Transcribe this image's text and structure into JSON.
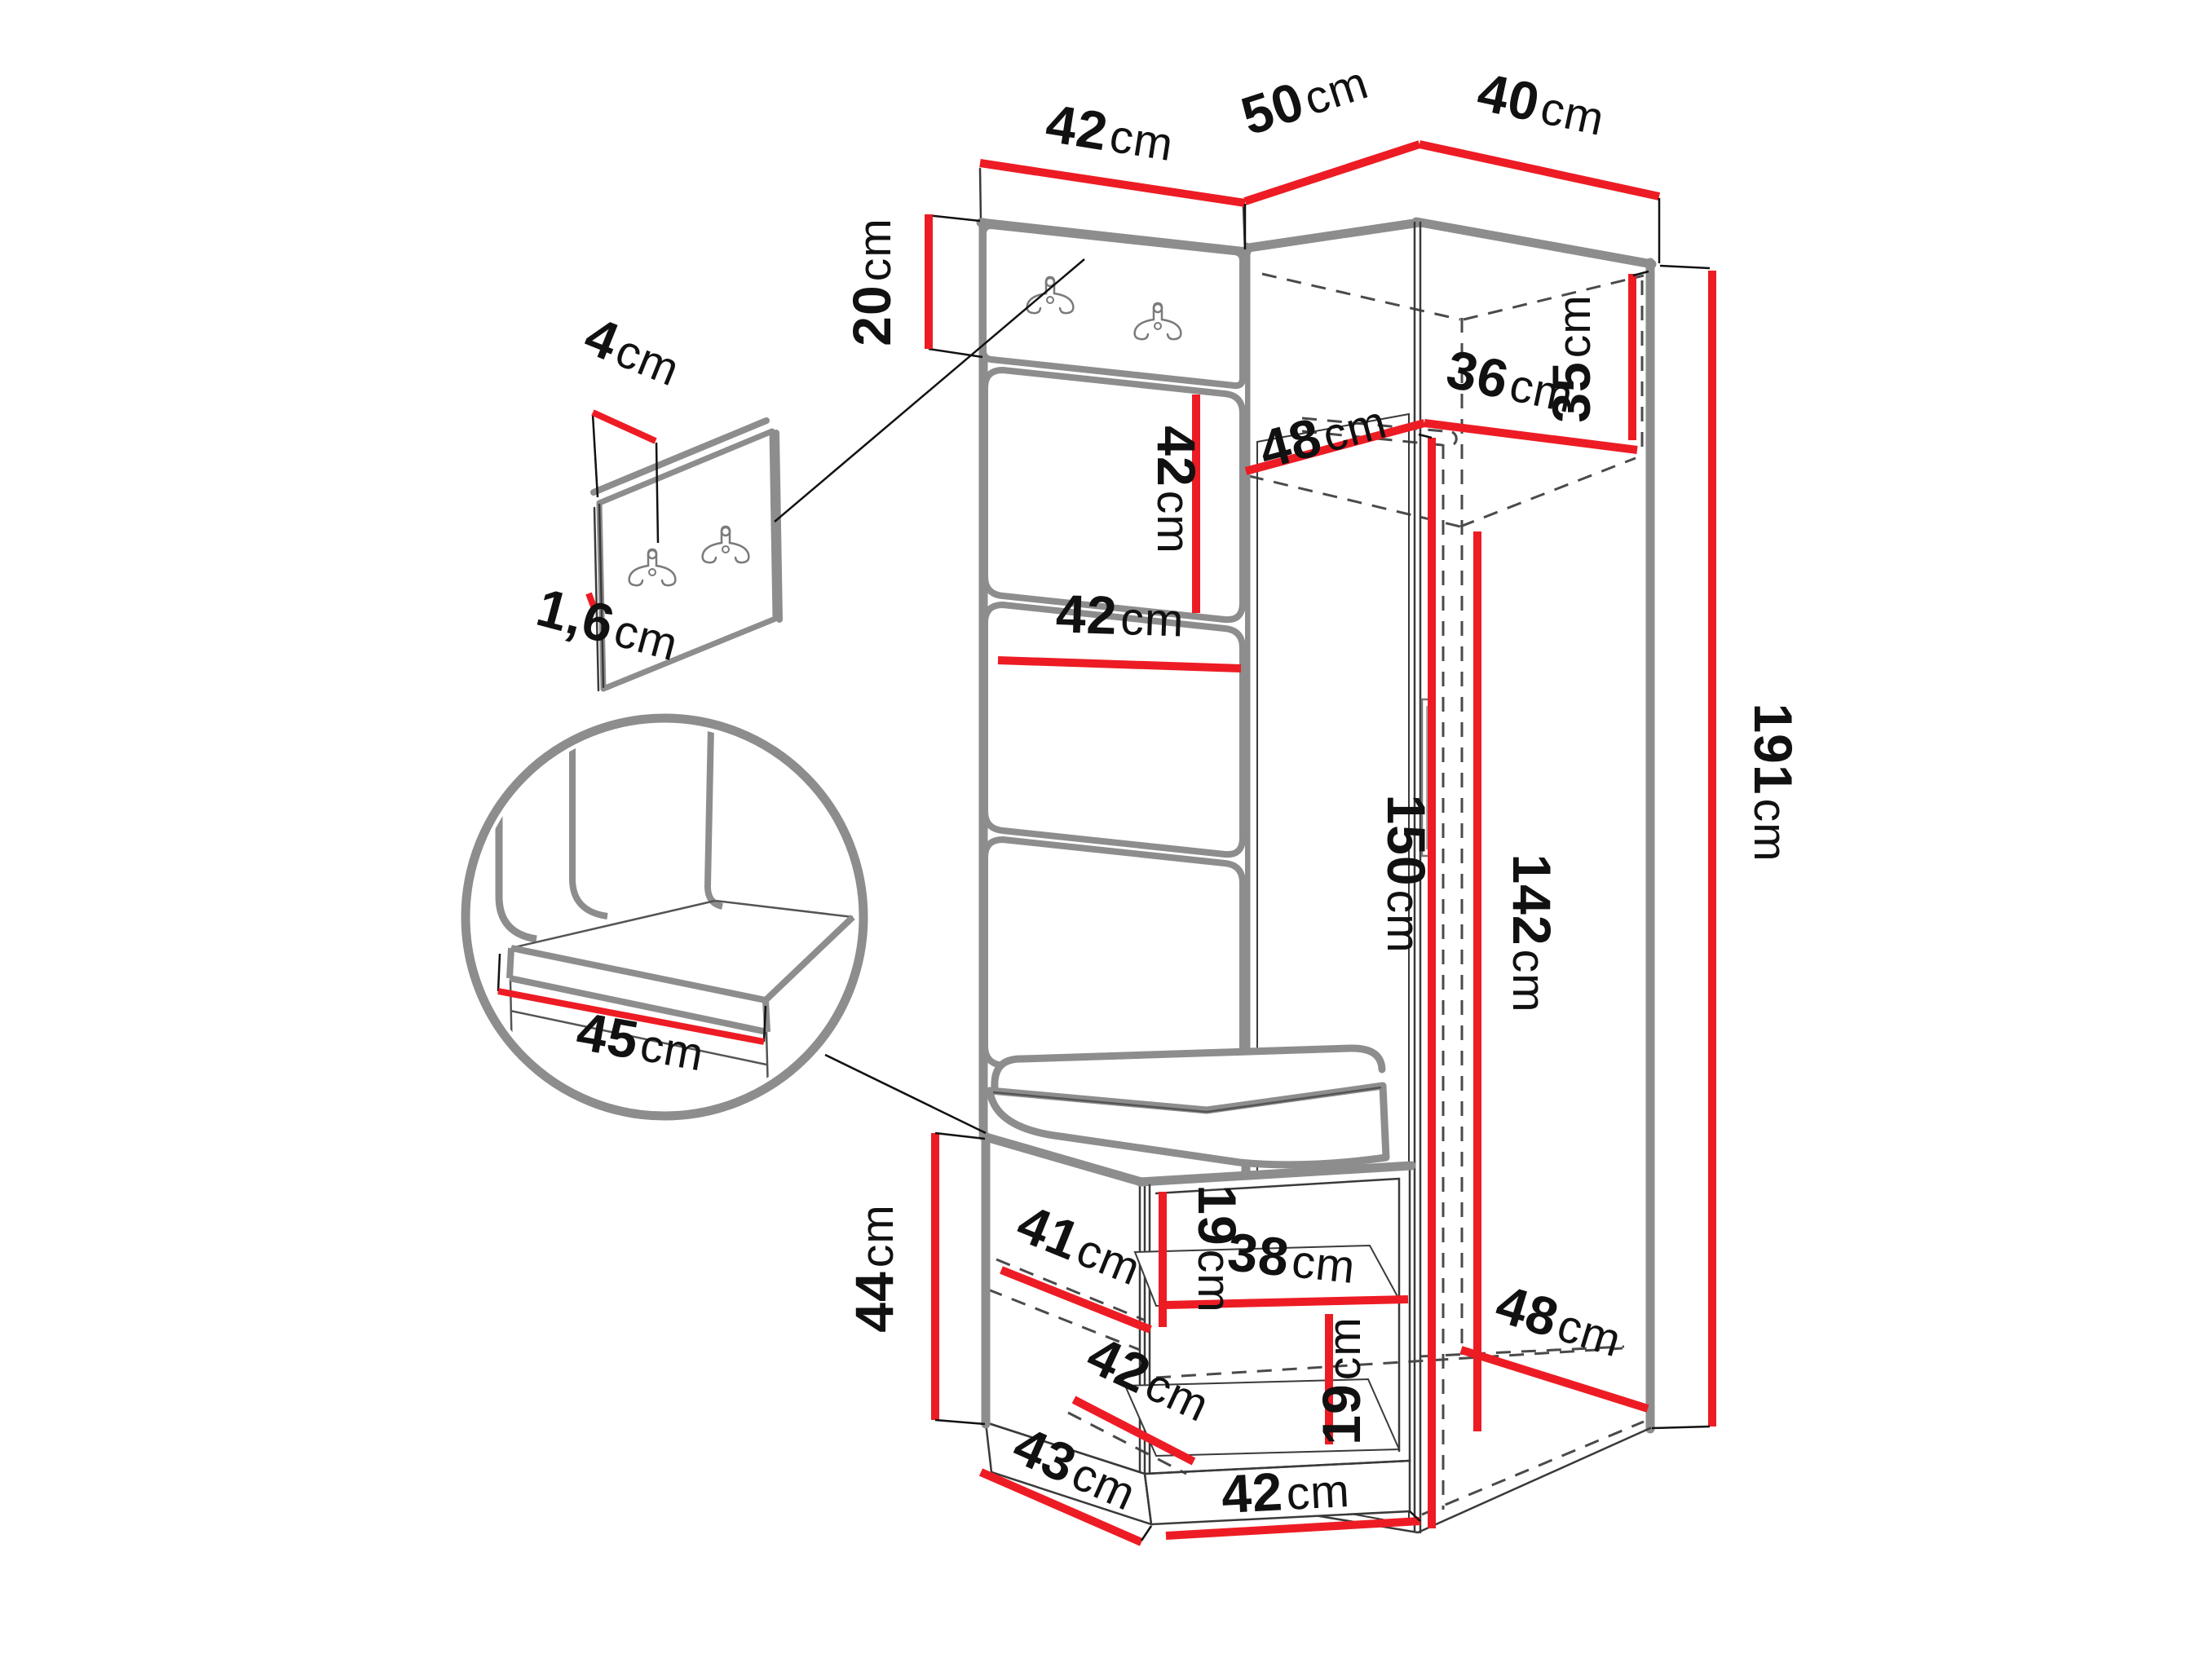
{
  "title": "",
  "unit_system": "cm",
  "colors": {
    "dimension_line": "#ed1c24",
    "structure_edge": "#8d8d8d",
    "detail_line": "#3a3a3a",
    "hidden_edge": "#4a4a4a",
    "label_text": "#111111",
    "background": "#ffffff"
  },
  "icons": {
    "hook": "double-coat-hook-icon"
  },
  "dimensions": {
    "top_panel_width": {
      "num": "42",
      "unit": "cm"
    },
    "top_left_width": {
      "num": "50",
      "unit": "cm"
    },
    "top_right_width": {
      "num": "40",
      "unit": "cm"
    },
    "hook_panel_height": {
      "num": "20",
      "unit": "cm"
    },
    "detail_panel_depth": {
      "num": "4",
      "unit": "cm"
    },
    "detail_panel_thickness": {
      "num": "1,6",
      "unit": "cm"
    },
    "upholstered_panel_height": {
      "num": "42",
      "unit": "cm"
    },
    "upholstered_panel_width": {
      "num": "42",
      "unit": "cm"
    },
    "wardrobe_interior_depth": {
      "num": "48",
      "unit": "cm"
    },
    "wardrobe_interior_width": {
      "num": "36",
      "unit": "cm"
    },
    "wardrobe_top_clearance": {
      "num": "35",
      "unit": "cm"
    },
    "wardrobe_door_height": {
      "num": "150",
      "unit": "cm"
    },
    "wardrobe_interior_height": {
      "num": "142",
      "unit": "cm"
    },
    "wardrobe_total_height": {
      "num": "191",
      "unit": "cm"
    },
    "seat_detail_length": {
      "num": "45",
      "unit": "cm"
    },
    "bench_height": {
      "num": "44",
      "unit": "cm"
    },
    "bench_shelf_depth": {
      "num": "41",
      "unit": "cm"
    },
    "bench_upper_inner_height": {
      "num": "19",
      "unit": "cm"
    },
    "bench_shelf_width": {
      "num": "38",
      "unit": "cm"
    },
    "bench_lower_inner_depth": {
      "num": "42",
      "unit": "cm"
    },
    "bench_lower_inner_height": {
      "num": "19",
      "unit": "cm"
    },
    "wardrobe_bottom_depth": {
      "num": "48",
      "unit": "cm"
    },
    "bench_depth": {
      "num": "43",
      "unit": "cm"
    },
    "bench_width": {
      "num": "42",
      "unit": "cm"
    }
  }
}
